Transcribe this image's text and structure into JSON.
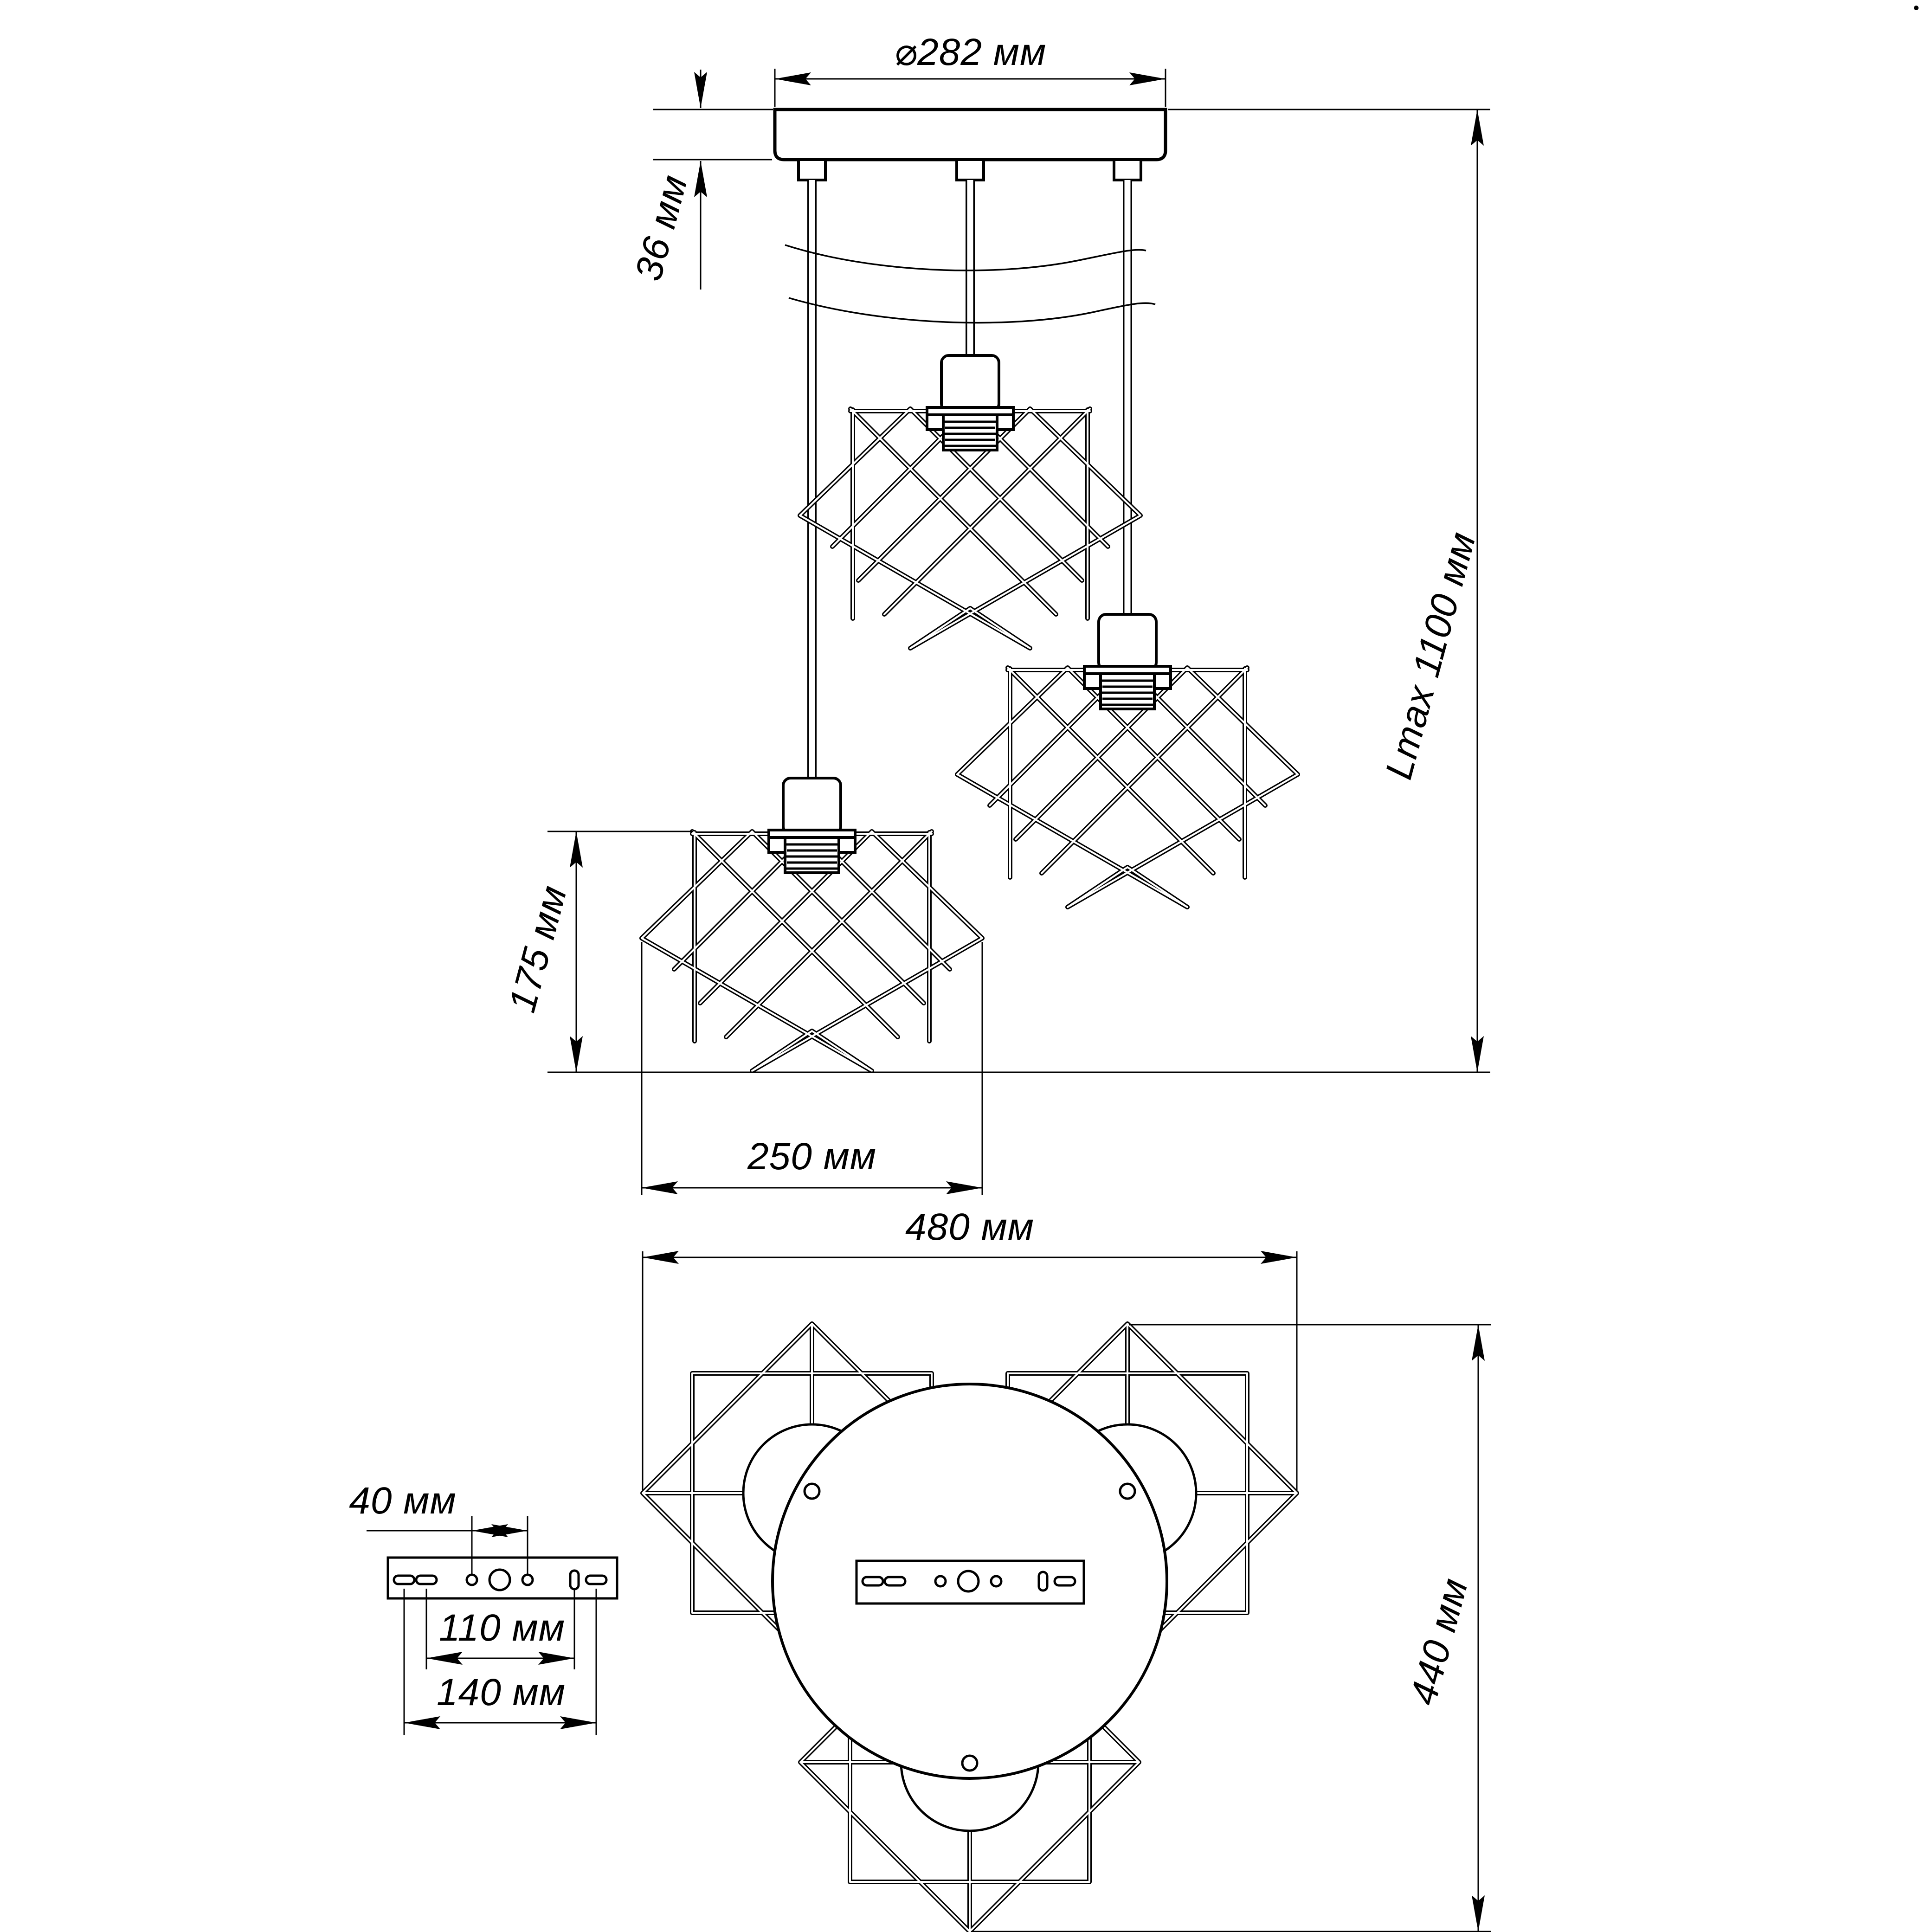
{
  "dims": {
    "canopy_diameter": "⌀282 мм",
    "canopy_height": "36 мм",
    "max_length": "Lmax 1100 мм",
    "shade_height": "175 мм",
    "shade_width": "250 мм",
    "fixture_width": "480 мм",
    "fixture_depth": "440 мм",
    "bracket_hole_gap": "40 мм",
    "bracket_slot_span": "110 мм",
    "bracket_overall_span": "140 мм"
  },
  "colors": {
    "line": "#000000",
    "background": "#ffffff"
  }
}
